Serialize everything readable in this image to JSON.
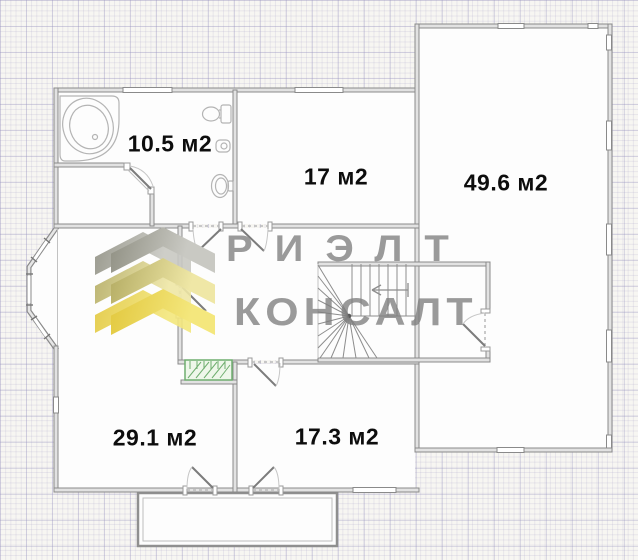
{
  "plan": {
    "type": "floor-plan",
    "watermark": {
      "line1": "РИЭЛТ",
      "line2": "КОНСАЛТ",
      "logo": "chevron-logo"
    },
    "rooms": [
      {
        "id": "bathroom",
        "label": "10.5 м2",
        "area_m2": 10.5
      },
      {
        "id": "room-17",
        "label": "17 м2",
        "area_m2": 17
      },
      {
        "id": "hall-49",
        "label": "49.6 м2",
        "area_m2": 49.6
      },
      {
        "id": "room-29",
        "label": "29.1 м2",
        "area_m2": 29.1
      },
      {
        "id": "room-17-3",
        "label": "17.3 м2",
        "area_m2": 17.3
      }
    ],
    "fixtures": [
      "corner-bathtub",
      "toilet",
      "wash-basin",
      "sink",
      "wardrobe",
      "winder-staircase",
      "bay-window",
      "porch"
    ],
    "colors": {
      "room_fill": "#fdfdfd",
      "wall_fill": "#e2e2e2",
      "wall_stroke": "#8a8a8a",
      "grid_minor": "rgba(172,167,202,0.22)",
      "grid_major": "rgba(150,145,190,0.30)",
      "watermark_gray": "#8a8a8a",
      "logo_yellow": "#e2c83e",
      "logo_olive": "#b3ab62",
      "logo_gray": "#9c9c94",
      "wardrobe_green": "#6fae6f"
    }
  }
}
